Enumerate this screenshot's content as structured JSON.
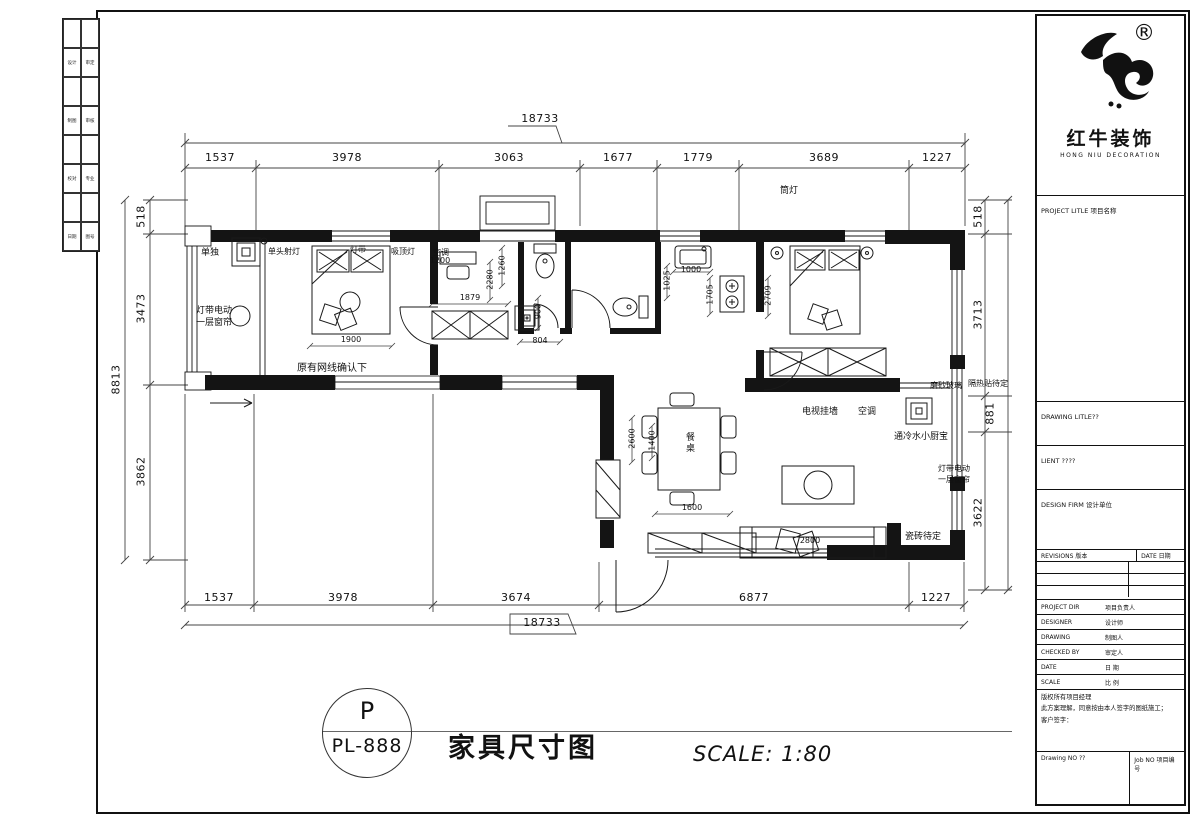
{
  "logo": {
    "reg": "®",
    "cn": "红牛装饰",
    "en": "HONG NIU DECORATION"
  },
  "strip": {
    "rows": [
      [
        "设计",
        "审定"
      ],
      [
        "制图",
        "审核"
      ],
      [
        "校对",
        "专业"
      ],
      [
        "日期",
        "图号"
      ]
    ]
  },
  "titleblock": {
    "project_title": "PROJECT LITLE 项目名称",
    "drawing_title": "DRAWING LITLE??",
    "client": "LIENT ????",
    "design_firm": "DESIGN FIRM 设计单位",
    "revisions": "REVISIONS 版本",
    "date_col": "DATE 日期",
    "rows": [
      {
        "en": "PROJECT DIR",
        "cn": "项目负责人"
      },
      {
        "en": "DESIGNER",
        "cn": "设计师"
      },
      {
        "en": "DRAWING",
        "cn": "制图人"
      },
      {
        "en": "CHECKED BY",
        "cn": "审定人"
      },
      {
        "en": "DATE",
        "cn": "日 期"
      },
      {
        "en": "SCALE",
        "cn": "比 例"
      }
    ],
    "copy1": "版权所有项目经理",
    "copy2": "此方案理解，同意按由本人签字的图纸施工；",
    "copy3": "客户签字：",
    "drawing_no": "Drawing NO ??",
    "job_no": "Job NO 项目编号"
  },
  "sheet": {
    "circle_top": "P",
    "circle_bottom": "PL-888",
    "title": "家具尺寸图",
    "scale": "SCALE: 1:80"
  },
  "dims": {
    "top_total": "18733",
    "top": [
      "1537",
      "3978",
      "3063",
      "1677",
      "1779",
      "3689",
      "1227"
    ],
    "bottom": [
      "1537",
      "3978",
      "3674",
      "6877",
      "1227"
    ],
    "bottom_total": "18733",
    "left_total": "8813",
    "left": [
      "518",
      "3473",
      "3862"
    ],
    "right": [
      "518",
      "3713",
      "881",
      "3622"
    ],
    "inner": {
      "bed1": "1900",
      "closet": "1879",
      "v1260": "1260",
      "v2280": "2280",
      "v900": "900",
      "w804": "804",
      "v1025": "1025",
      "sink": "1000",
      "v1705": "1705",
      "bed2": "2709",
      "v2600": "2600",
      "v1400": "1400",
      "tv": "1600",
      "sofa": "2800",
      "ac": "1200"
    }
  },
  "labels": {
    "downlight": "筒灯",
    "standalone": "单独",
    "spotlight": "单头射灯",
    "lightstrip": "灯带",
    "ceilinglight": "吸顶灯",
    "ac1": "空调",
    "curtain_a": "灯带电动",
    "curtain_b": "一层窗帘",
    "network": "原有网线确认下",
    "tvwall": "电视挂墙",
    "ac2": "空调",
    "heater": "通冷水小厨宝",
    "frosted": "磨砂玻璃",
    "insulation": "隔热贴待定",
    "curtain2_a": "灯带电动",
    "curtain2_b": "一层窗帘",
    "tile": "瓷砖待定",
    "table": "餐桌"
  }
}
